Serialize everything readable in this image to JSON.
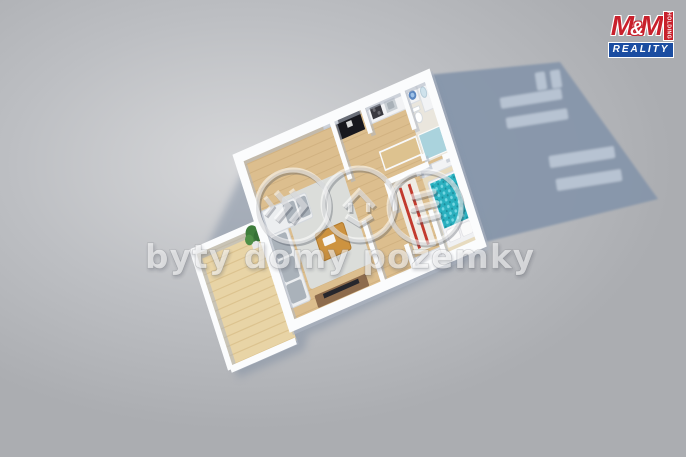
{
  "scene": {
    "description": "3D isometric render of an apartment floor plan casting a shadow with window openings",
    "rooms": [
      "balcony",
      "living-room",
      "entry-hall",
      "kitchen",
      "study",
      "bedroom",
      "bathroom"
    ],
    "furniture": [
      "corner-sofa",
      "coffee-table",
      "tv-stand",
      "potted-plant",
      "black-wardrobe",
      "kitchen-cabinets",
      "kitchen-counter",
      "striped-rug",
      "double-bed",
      "wardrobe",
      "desk",
      "washing-machine",
      "bathroom-vanity",
      "toilet",
      "shower"
    ]
  },
  "watermark": {
    "text": "byty domy pozemky",
    "icons": [
      {
        "name": "chevrons-icon"
      },
      {
        "name": "house-icon"
      },
      {
        "name": "land-plots-icon"
      }
    ]
  },
  "logo": {
    "m1": "M",
    "amp": "&",
    "m2": "M",
    "subtitle": "REALITY",
    "vertical_text": "HOLDING"
  },
  "colors": {
    "bg-center": "#d7d8da",
    "bg-mid": "#bdbfc3",
    "bg-edge": "#abadb1",
    "shadow": "#8495a9",
    "shadow-window": "#b7c3d2",
    "wall": "#fbfcfd",
    "wood": "#dcbe8e",
    "wood-line": "#c9a876",
    "balcony-wood": "#e8d4a6",
    "balcony-line": "#d4b780",
    "rug-gray": "#dbddda",
    "sofa": "#eceef0",
    "sofa-cushion": "#aab2ba",
    "table-wood": "#cd9340",
    "tv-stand": "#8d6b4c",
    "tv-screen": "#26262c",
    "black-furniture": "#17171d",
    "cabinet-white": "#f2f3f5",
    "counter-wood": "#ddc28f",
    "bed-teal": "#2ab0bf",
    "bed-teal-light": "#7edbe6",
    "carpet-cream": "#e7dbbf",
    "rug-white": "#efece4",
    "rug-red": "#c23b2e",
    "bath-floor": "#eae6dd",
    "bath-blue": "#9fd0de",
    "logo-red": "#c8202c",
    "logo-blue": "#1b4da1"
  }
}
